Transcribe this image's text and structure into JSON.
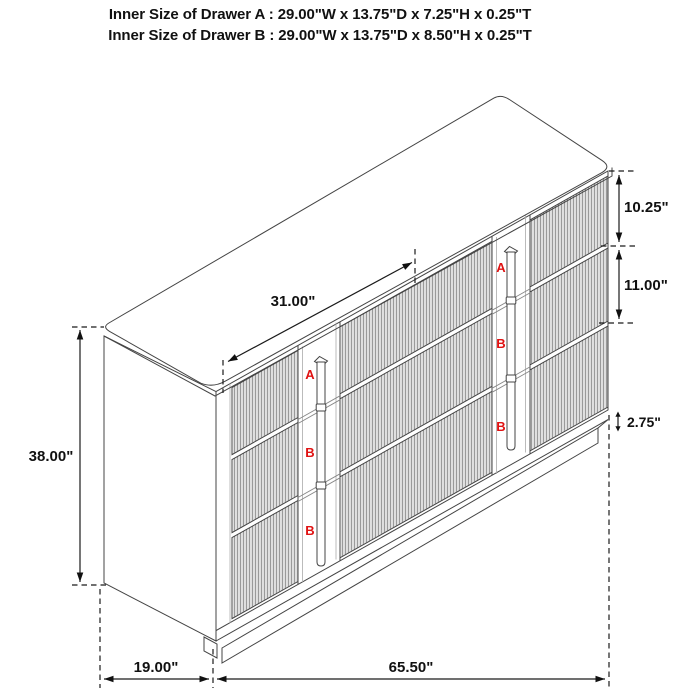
{
  "title": {
    "line1": "Inner Size of Drawer A : 29.00\"W x 13.75\"D x 7.25\"H x 0.25\"T",
    "line2": "Inner Size of Drawer B : 29.00\"W x 13.75\"D x 8.50\"H x 0.25\"T"
  },
  "dimensions": {
    "top_width": "31.00\"",
    "total_height": "38.00\"",
    "drawer_a_front_height": "10.25\"",
    "drawer_b_front_height": "11.00\"",
    "base_height": "2.75\"",
    "depth": "19.00\"",
    "total_width": "65.50\""
  },
  "drawer_labels": {
    "left": [
      "A",
      "B",
      "B"
    ],
    "right": [
      "A",
      "B",
      "B"
    ]
  },
  "colors": {
    "line": "#444444",
    "flute": "#707070",
    "dimension": "#111111",
    "label_red": "#e01212",
    "background": "#ffffff"
  }
}
